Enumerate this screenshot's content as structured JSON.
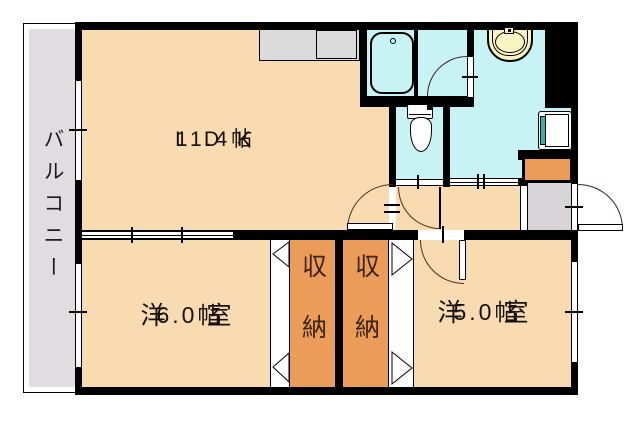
{
  "plan_title": "apartment floor plan",
  "balcony": {
    "label": "バルコニー"
  },
  "rooms": {
    "ldk": {
      "label": "L D K",
      "size": "11.4帖"
    },
    "bedroom_west": {
      "label": "洋　室",
      "size": "6.0帖"
    },
    "bedroom_east": {
      "label": "洋　室",
      "size": "5.0帖"
    },
    "closet_west": {
      "label": "収納"
    },
    "closet_east": {
      "label": "収納"
    }
  },
  "fixtures": {
    "icons": [
      "bathtub-icon",
      "washbasin-icon",
      "toilet-icon",
      "washing-machine-pan-icon",
      "kitchen-counter-icon",
      "shoe-cabinet-icon",
      "entrance-door-icon",
      "window-icon",
      "sliding-door-icon",
      "folding-closet-door-icon"
    ]
  },
  "colors": {
    "room_fill": "#F8DBB0",
    "closet_fill": "#EC9C59",
    "wet_area_fill": "#C8F3F5",
    "balcony_fill": "#E0DDE0",
    "genkan_fill": "#D8D4D7",
    "counter_fill": "#DADADA",
    "basin_fill": "#FAF3C2",
    "washer_accent": "#2FB5AD",
    "wall": "#000000",
    "door_arc": "#5A2A25"
  }
}
